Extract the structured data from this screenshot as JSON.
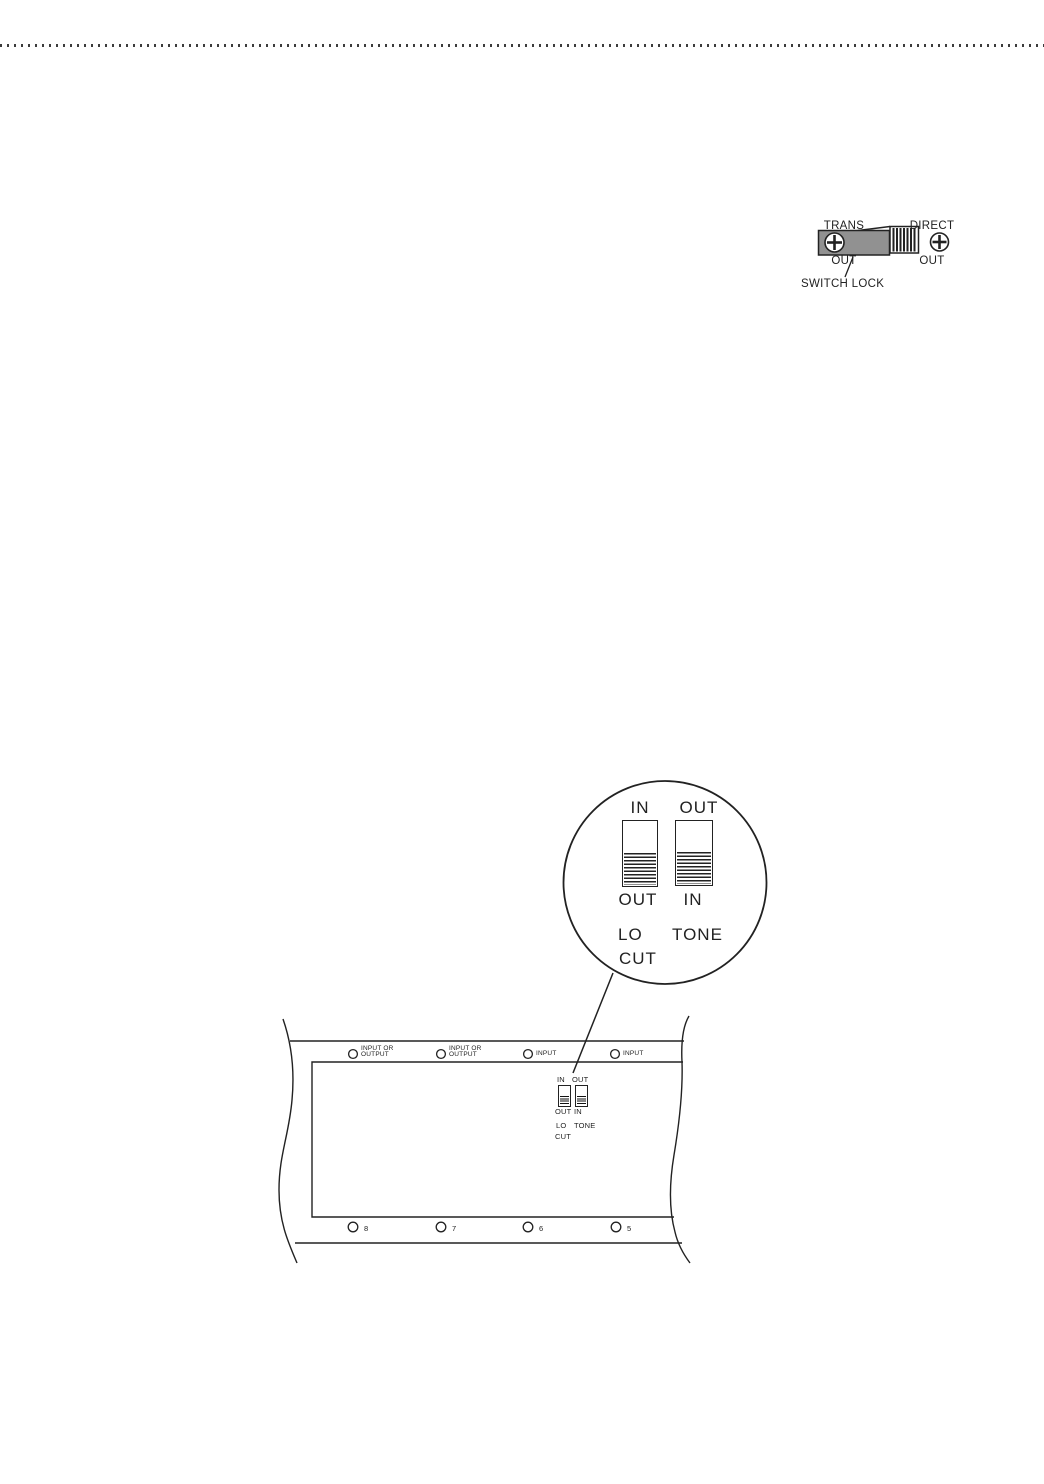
{
  "colors": {
    "ink": "#222222",
    "switch_lock_body_gray": "#919191",
    "page_background": "#ffffff",
    "dotted_rule": "#3c3c3c"
  },
  "switch_lock_figure": {
    "trans_label_line1": "TRANS",
    "trans_label_line2": "OUT",
    "direct_label_line1": "DIRECT",
    "direct_label_line2": "OUT",
    "caption": "SWITCH LOCK"
  },
  "magnifier_detail": {
    "left_switch_top": "IN",
    "right_switch_top": "OUT",
    "left_switch_bottom": "OUT",
    "right_switch_bottom": "IN",
    "left_switch_name_line1": "LO",
    "left_switch_name_line2": "CUT",
    "right_switch_name": "TONE",
    "left_switch_position": "down",
    "right_switch_position": "down"
  },
  "rear_panel": {
    "top_jacks": [
      {
        "line1": "INPUT OR",
        "line2": "OUTPUT"
      },
      {
        "line1": "INPUT OR",
        "line2": "OUTPUT"
      },
      {
        "line1": "INPUT",
        "line2": ""
      },
      {
        "line1": "INPUT",
        "line2": ""
      }
    ],
    "bottom_jacks": [
      "8",
      "7",
      "6",
      "5"
    ],
    "switch_labels": {
      "left_top": "IN",
      "right_top": "OUT",
      "left_bottom": "OUT",
      "right_bottom": "IN",
      "lo": "LO",
      "cut": "CUT",
      "tone": "TONE"
    }
  }
}
